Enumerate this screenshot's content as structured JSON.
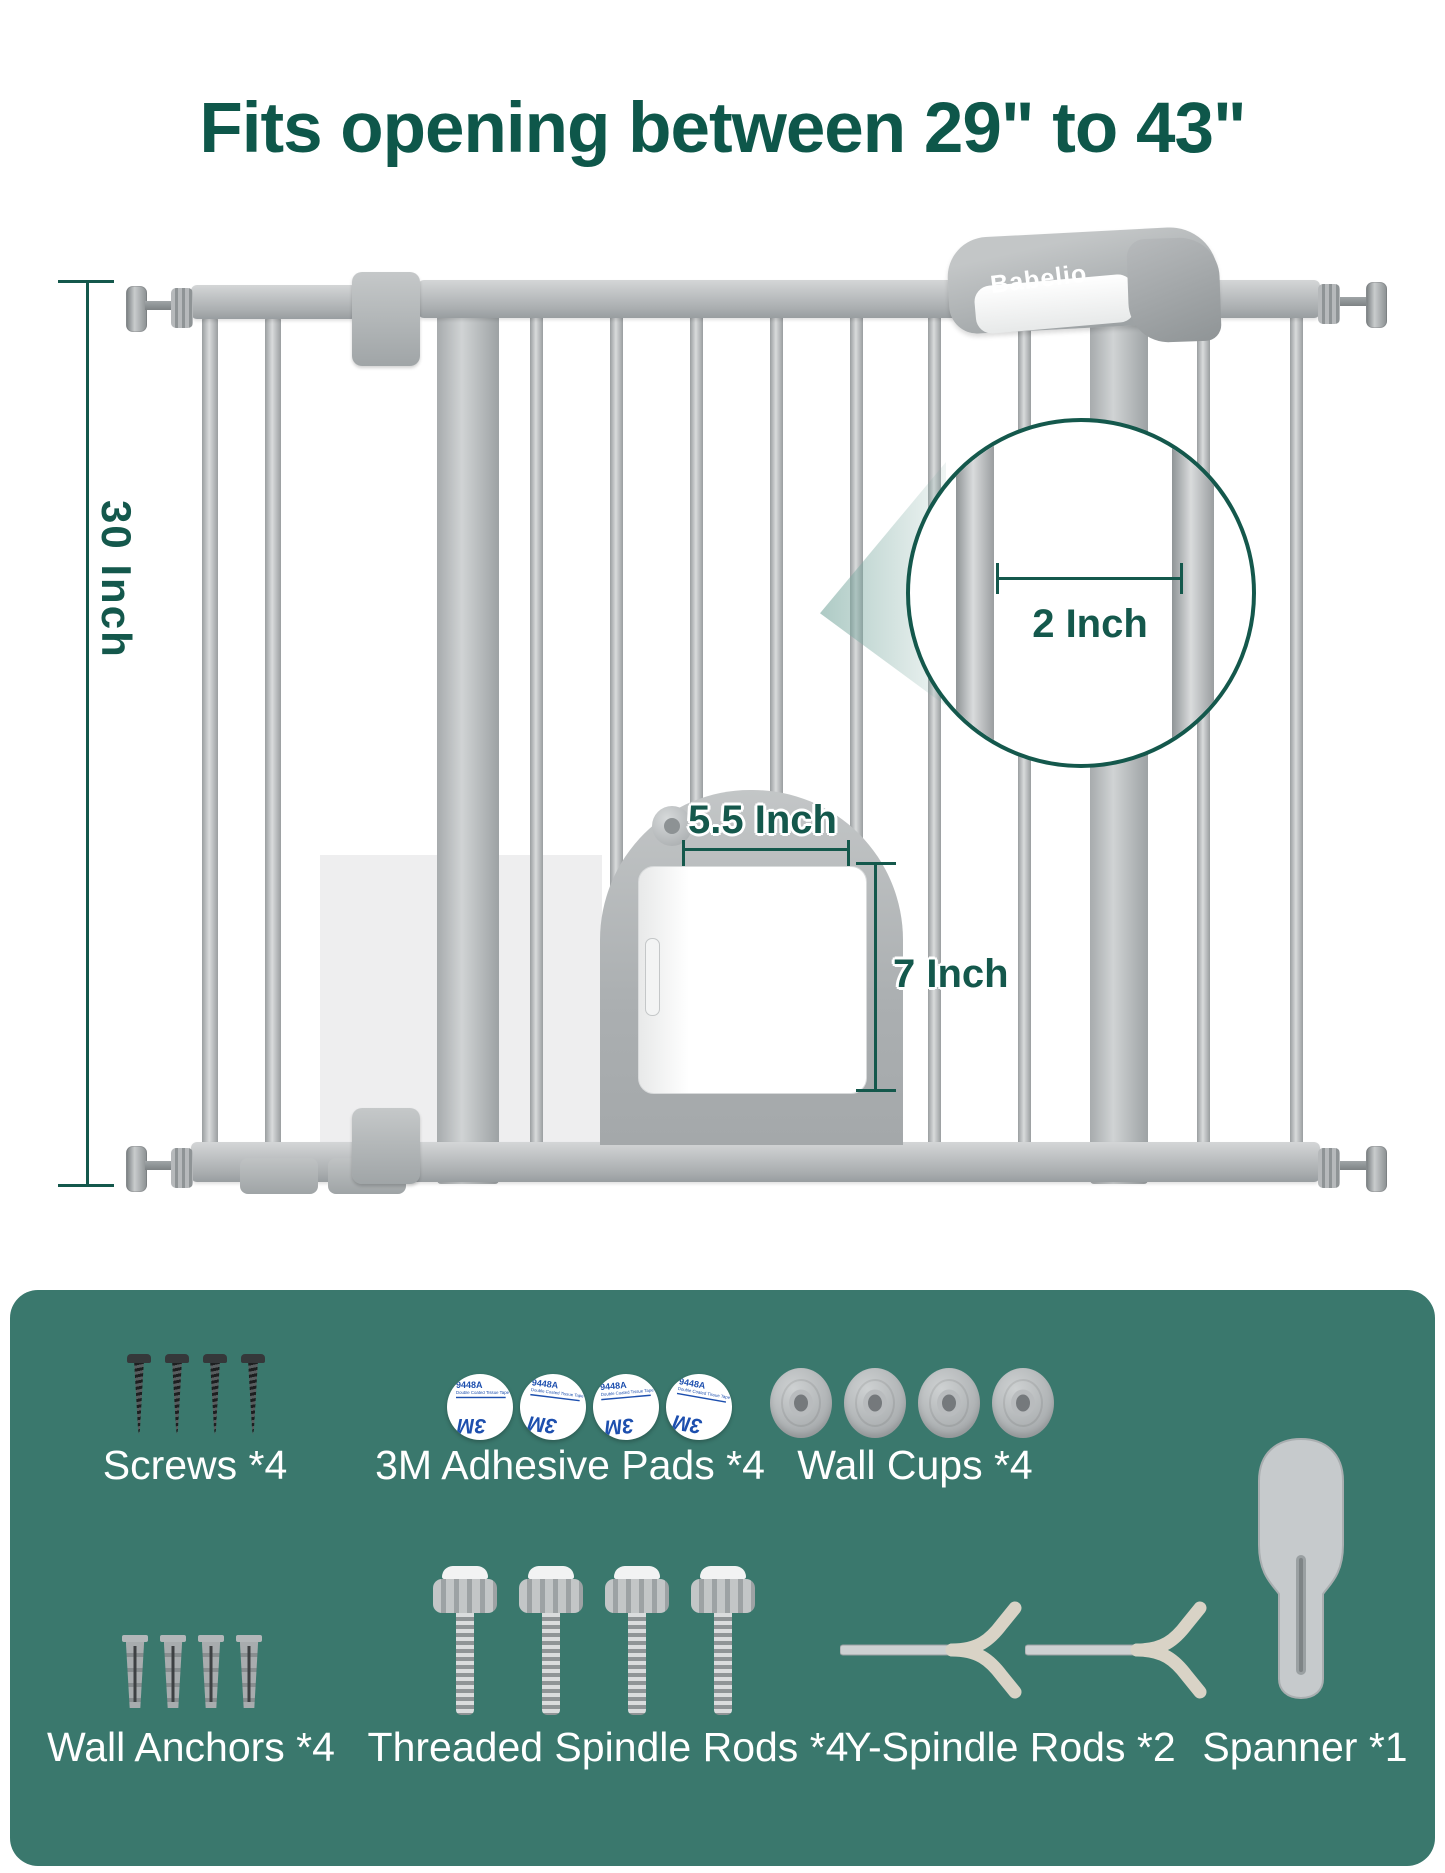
{
  "title": "Fits opening between 29\" to 43\"",
  "brand": "Babelio",
  "dimensions": {
    "gate_height": "30 Inch",
    "bar_gap": "2 Inch",
    "pet_door_width": "5.5 Inch",
    "pet_door_height": "7 Inch"
  },
  "accessories": {
    "screws": "Screws *4",
    "adhesive_pads": "3M Adhesive Pads *4",
    "wall_cups": "Wall Cups *4",
    "wall_anchors": "Wall Anchors *4",
    "threaded_spindle_rods": "Threaded Spindle Rods *4",
    "y_spindle_rods": "Y-Spindle Rods *2",
    "spanner": "Spanner *1"
  },
  "adhesive_pad_print": {
    "model": "9448A",
    "description": "Double Coated Tissue Tape",
    "brand": "3M"
  },
  "colors": {
    "title_green": "#0e574a",
    "dimension_green": "#14584c",
    "panel_teal": "#3a786d",
    "pad_blue": "#1d4fae",
    "gate_gray": "#b5b8ba"
  }
}
